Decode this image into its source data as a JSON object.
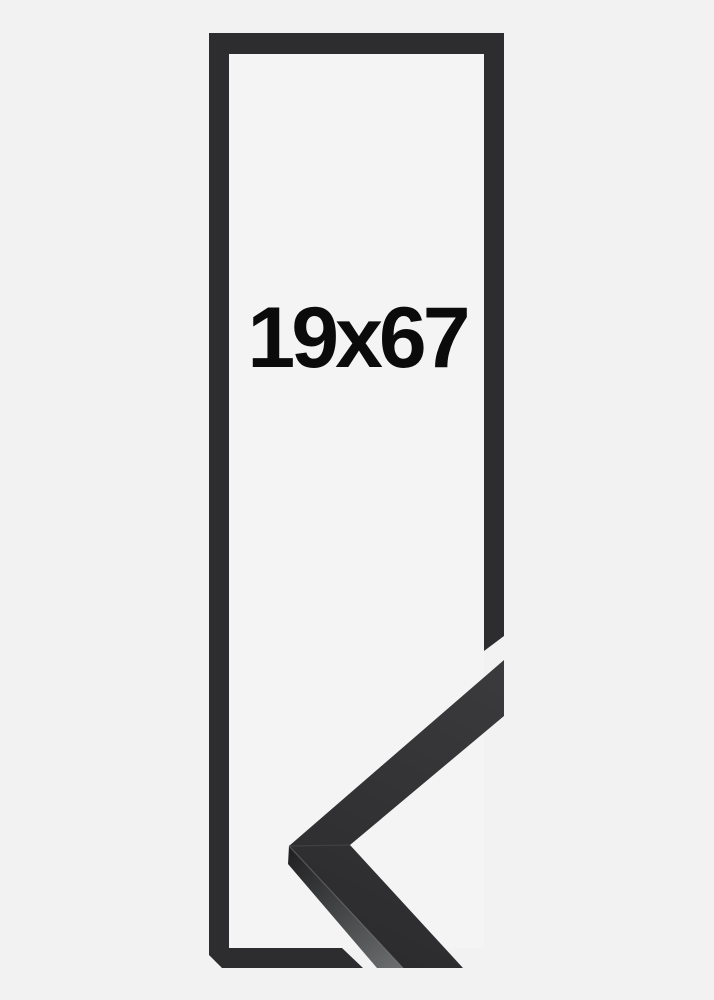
{
  "product": {
    "size_label": "19x67"
  },
  "colors": {
    "background": "#f2f2f3",
    "frame_opening_fill": "#f4f4f5",
    "frame": "#2d2d2f",
    "moulding_face_start": "#3b3b3d",
    "moulding_face_end": "#2b2b2d",
    "moulding_side_start": "#1f1f21",
    "moulding_side_mid": "#47494b",
    "moulding_side_end": "#6b6d6f",
    "miter_seam": "#454547",
    "edge_highlight": "#8a8a8a",
    "label": "#0b0b0b"
  }
}
